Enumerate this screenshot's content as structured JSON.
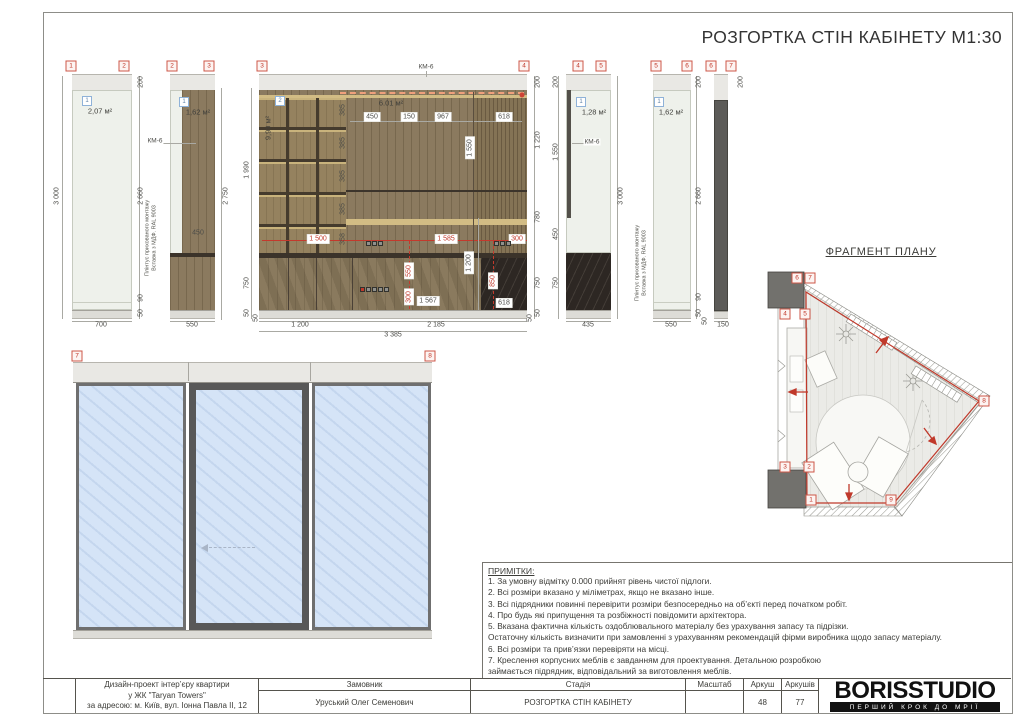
{
  "sheet": {
    "title": "РОЗГОРТКА СТІН КАБІНЕТУ М1:30"
  },
  "plan": {
    "title": "ФРАГМЕНТ ПЛАНУ"
  },
  "notes": {
    "title": "ПРИМІТКИ:",
    "lines": [
      "1. За умовну відмітку 0.000 прийнят рівень чистої підлоги.",
      "2. Всі розміри вказано у міліметрах, якщо не вказано інше.",
      "3. Всі підрядники повинні перевірити розміри безпосередньо на об’єкті перед початком робіт.",
      "4. Про будь які припущення та розбіжності повідомити архітектора.",
      "5. Вказана фактична кількість оздоблювального матеріалу без урахування запасу та підрізки.",
      "Остаточну кількість визначити при замовленні з урахуванням рекомендацій фірми виробника щодо запасу матеріалу.",
      "6. Всі розміри та прив’язки перевіряти на місці.",
      "7. Креслення корпусних меблів є завданням для проектування. Детальною розробкою",
      "займається підрядник, відповідальний за виготовлення меблів."
    ]
  },
  "titleblock": {
    "project": [
      "Дизайн-проект інтер’єру квартири",
      "у ЖК \"Taryan Towers\"",
      "за адресою: м. Київ, вул. Іонна Павла II, 12"
    ],
    "cols": [
      {
        "header": "Замовник",
        "value": "Уруський Олег Семенович"
      },
      {
        "header": "Стадія",
        "value": "РОЗГОРТКА СТІН КАБІНЕТУ"
      },
      {
        "header": "Масштаб",
        "value": ""
      },
      {
        "header": "Аркуш",
        "value": "48"
      },
      {
        "header": "Аркушів",
        "value": "77"
      }
    ],
    "logo": {
      "name": "BORISSTUDIO",
      "tagline": "ПЕРШИЙ КРОК ДО МРІЇ"
    }
  },
  "annotations": {
    "markers": [
      {
        "n": "1",
        "x": 71,
        "y": 66
      },
      {
        "n": "2",
        "x": 124,
        "y": 66
      },
      {
        "n": "2",
        "x": 172,
        "y": 66
      },
      {
        "n": "3",
        "x": 209,
        "y": 66
      },
      {
        "n": "3",
        "x": 262,
        "y": 66
      },
      {
        "n": "4",
        "x": 524,
        "y": 66
      },
      {
        "n": "4",
        "x": 578,
        "y": 66
      },
      {
        "n": "5",
        "x": 601,
        "y": 66
      },
      {
        "n": "5",
        "x": 656,
        "y": 66
      },
      {
        "n": "6",
        "x": 687,
        "y": 66
      },
      {
        "n": "6",
        "x": 711,
        "y": 66
      },
      {
        "n": "7",
        "x": 731,
        "y": 66
      },
      {
        "n": "7",
        "x": 77,
        "y": 356
      },
      {
        "n": "8",
        "x": 430,
        "y": 356
      },
      {
        "n": "6",
        "x": 797,
        "y": 278
      },
      {
        "n": "7",
        "x": 810,
        "y": 278
      },
      {
        "n": "4",
        "x": 785,
        "y": 314
      },
      {
        "n": "5",
        "x": 805,
        "y": 314
      },
      {
        "n": "3",
        "x": 785,
        "y": 467
      },
      {
        "n": "2",
        "x": 809,
        "y": 467
      },
      {
        "n": "1",
        "x": 811,
        "y": 500
      },
      {
        "n": "9",
        "x": 891,
        "y": 500
      },
      {
        "n": "8",
        "x": 984,
        "y": 401
      }
    ],
    "badges": [
      {
        "n": "1",
        "x": 87,
        "y": 101
      },
      {
        "n": "1",
        "x": 184,
        "y": 102
      },
      {
        "n": "2",
        "x": 280,
        "y": 101
      },
      {
        "n": "1",
        "x": 581,
        "y": 102
      },
      {
        "n": "1",
        "x": 659,
        "y": 102
      }
    ],
    "areas": [
      {
        "t": "2,07 м²",
        "x": 100,
        "y": 111
      },
      {
        "t": "1,62 м²",
        "x": 198,
        "y": 112
      },
      {
        "t": "9,99 м²",
        "x": 268,
        "y": 128,
        "c": "rot"
      },
      {
        "t": "6.01 м²",
        "x": 391,
        "y": 103
      },
      {
        "t": "1,28 м²",
        "x": 594,
        "y": 112
      },
      {
        "t": "1,62 м²",
        "x": 671,
        "y": 112
      }
    ],
    "kms": [
      {
        "t": "КМ-6",
        "x": 155,
        "y": 141
      },
      {
        "t": "КМ-6",
        "x": 426,
        "y": 67
      },
      {
        "t": "КМ-6",
        "x": 592,
        "y": 142
      }
    ],
    "vtexts": [
      {
        "l1": "Плінтус прихованого монтажу",
        "l2": "Вставка з МДФ. RAL 9003",
        "x": 151,
        "y": 238
      },
      {
        "l1": "Плінтус прихованого монтажу",
        "l2": "Вставка з МДФ. RAL 9003",
        "x": 641,
        "y": 263
      }
    ],
    "dims": [
      {
        "t": "3 000",
        "x": 57,
        "y": 196,
        "c": "rot"
      },
      {
        "t": "200",
        "x": 141,
        "y": 82,
        "c": "rot"
      },
      {
        "t": "2 660",
        "x": 141,
        "y": 196,
        "c": "rot"
      },
      {
        "t": "90",
        "x": 141,
        "y": 298,
        "c": "rot"
      },
      {
        "t": "50",
        "x": 141,
        "y": 313,
        "c": "rot"
      },
      {
        "t": "700",
        "x": 101,
        "y": 325
      },
      {
        "t": "2 750",
        "x": 226,
        "y": 196,
        "c": "rot"
      },
      {
        "t": "450",
        "x": 198,
        "y": 233
      },
      {
        "t": "550",
        "x": 192,
        "y": 325
      },
      {
        "t": "1 990",
        "x": 247,
        "y": 170,
        "c": "rot"
      },
      {
        "t": "750",
        "x": 247,
        "y": 283,
        "c": "rot"
      },
      {
        "t": "50",
        "x": 247,
        "y": 313,
        "c": "rot"
      },
      {
        "t": "200",
        "x": 538,
        "y": 82,
        "c": "rot"
      },
      {
        "t": "1 220",
        "x": 538,
        "y": 140,
        "c": "rot"
      },
      {
        "t": "780",
        "x": 538,
        "y": 217,
        "c": "rot"
      },
      {
        "t": "750",
        "x": 538,
        "y": 283,
        "c": "rot"
      },
      {
        "t": "50",
        "x": 538,
        "y": 313,
        "c": "rot"
      },
      {
        "t": "450",
        "x": 372,
        "y": 117,
        "c": "box"
      },
      {
        "t": "150",
        "x": 409,
        "y": 117,
        "c": "box"
      },
      {
        "t": "967",
        "x": 443,
        "y": 117,
        "c": "box"
      },
      {
        "t": "618",
        "x": 504,
        "y": 117,
        "c": "box"
      },
      {
        "t": "385",
        "x": 343,
        "y": 110,
        "c": "rot"
      },
      {
        "t": "385",
        "x": 343,
        "y": 143,
        "c": "rot"
      },
      {
        "t": "385",
        "x": 343,
        "y": 176,
        "c": "rot"
      },
      {
        "t": "385",
        "x": 343,
        "y": 209,
        "c": "rot"
      },
      {
        "t": "358",
        "x": 343,
        "y": 239,
        "c": "rot"
      },
      {
        "t": "1 550",
        "x": 470,
        "y": 148,
        "c": "rot box"
      },
      {
        "t": "1 500",
        "x": 318,
        "y": 239,
        "c": "red box"
      },
      {
        "t": "1 585",
        "x": 446,
        "y": 239,
        "c": "red box"
      },
      {
        "t": "300",
        "x": 517,
        "y": 239,
        "c": "red box"
      },
      {
        "t": "550",
        "x": 409,
        "y": 271,
        "c": "rot red box"
      },
      {
        "t": "300",
        "x": 409,
        "y": 297,
        "c": "rot red box"
      },
      {
        "t": "850",
        "x": 493,
        "y": 281,
        "c": "rot red box"
      },
      {
        "t": "1 200",
        "x": 469,
        "y": 263,
        "c": "rot box"
      },
      {
        "t": "1 567",
        "x": 428,
        "y": 301,
        "c": "box"
      },
      {
        "t": "618",
        "x": 504,
        "y": 303,
        "c": "box"
      },
      {
        "t": "1 200",
        "x": 300,
        "y": 325
      },
      {
        "t": "2 185",
        "x": 436,
        "y": 325
      },
      {
        "t": "3 385",
        "x": 393,
        "y": 335
      },
      {
        "t": "50",
        "x": 256,
        "y": 318,
        "c": "rot"
      },
      {
        "t": "50",
        "x": 530,
        "y": 318,
        "c": "rot"
      },
      {
        "t": "200",
        "x": 556,
        "y": 82,
        "c": "rot"
      },
      {
        "t": "1 550",
        "x": 556,
        "y": 152,
        "c": "rot"
      },
      {
        "t": "450",
        "x": 556,
        "y": 234,
        "c": "rot"
      },
      {
        "t": "750",
        "x": 556,
        "y": 283,
        "c": "rot"
      },
      {
        "t": "3 000",
        "x": 621,
        "y": 196,
        "c": "rot"
      },
      {
        "t": "435",
        "x": 588,
        "y": 325
      },
      {
        "t": "200",
        "x": 699,
        "y": 82,
        "c": "rot"
      },
      {
        "t": "2 660",
        "x": 699,
        "y": 196,
        "c": "rot"
      },
      {
        "t": "90",
        "x": 699,
        "y": 297,
        "c": "rot"
      },
      {
        "t": "50",
        "x": 699,
        "y": 313,
        "c": "rot"
      },
      {
        "t": "550",
        "x": 671,
        "y": 325
      },
      {
        "t": "200",
        "x": 741,
        "y": 82,
        "c": "rot"
      },
      {
        "t": "50",
        "x": 705,
        "y": 321,
        "c": "rot"
      },
      {
        "t": "150",
        "x": 723,
        "y": 325
      }
    ],
    "lines": [
      {
        "x": 62,
        "y": 76,
        "w": 1,
        "h": 243
      },
      {
        "x": 139,
        "y": 76,
        "w": 1,
        "h": 243
      },
      {
        "x": 72,
        "y": 321,
        "w": 60,
        "h": 1
      },
      {
        "x": 221,
        "y": 88,
        "w": 1,
        "h": 232
      },
      {
        "x": 170,
        "y": 321,
        "w": 45,
        "h": 1
      },
      {
        "x": 163,
        "y": 143,
        "w": 33,
        "h": 1
      },
      {
        "x": 251,
        "y": 88,
        "w": 1,
        "h": 231
      },
      {
        "x": 534,
        "y": 76,
        "w": 1,
        "h": 243
      },
      {
        "x": 259,
        "y": 321,
        "w": 268,
        "h": 1
      },
      {
        "x": 259,
        "y": 331,
        "w": 268,
        "h": 1
      },
      {
        "x": 350,
        "y": 121,
        "w": 172,
        "h": 1
      },
      {
        "x": 262,
        "y": 240,
        "w": 265,
        "h": 1,
        "c": "#c4392c"
      },
      {
        "x": 409,
        "y": 241,
        "w": 1,
        "h": 68,
        "c": "#c4392c",
        "d": 1
      },
      {
        "x": 493,
        "y": 241,
        "w": 1,
        "h": 68,
        "c": "#c4392c",
        "d": 1
      },
      {
        "x": 478,
        "y": 218,
        "w": 1,
        "h": 92
      },
      {
        "x": 340,
        "y": 92,
        "w": 184,
        "h": 2,
        "c": "#efa07c",
        "d": 1
      },
      {
        "x": 426,
        "y": 71,
        "w": 1,
        "h": 6
      },
      {
        "x": 558,
        "y": 76,
        "w": 1,
        "h": 243
      },
      {
        "x": 617,
        "y": 76,
        "w": 1,
        "h": 243
      },
      {
        "x": 566,
        "y": 321,
        "w": 45,
        "h": 1
      },
      {
        "x": 572,
        "y": 143,
        "w": 15,
        "h": 1
      },
      {
        "x": 696,
        "y": 76,
        "w": 1,
        "h": 243
      },
      {
        "x": 653,
        "y": 321,
        "w": 38,
        "h": 1
      },
      {
        "x": 714,
        "y": 321,
        "w": 14,
        "h": 1
      },
      {
        "x": 288,
        "y": 258,
        "w": 1,
        "h": 52,
        "c": "#4a4036"
      },
      {
        "x": 316,
        "y": 258,
        "w": 1,
        "h": 52,
        "c": "#4a4036"
      },
      {
        "x": 352,
        "y": 258,
        "w": 1,
        "h": 52,
        "c": "#4a4036"
      },
      {
        "x": 473,
        "y": 92,
        "w": 1,
        "h": 218,
        "c": "#5a4e3e"
      },
      {
        "x": 346,
        "y": 190,
        "w": 181,
        "h": 2,
        "c": "#3c342b"
      }
    ],
    "sockets": [
      {
        "x": 366,
        "y": 241,
        "n": 3
      },
      {
        "x": 494,
        "y": 241,
        "n": 3
      },
      {
        "x": 360,
        "y": 287,
        "n": 5,
        "red": 1
      }
    ],
    "dots": [
      {
        "x": 522,
        "y": 95
      }
    ]
  }
}
